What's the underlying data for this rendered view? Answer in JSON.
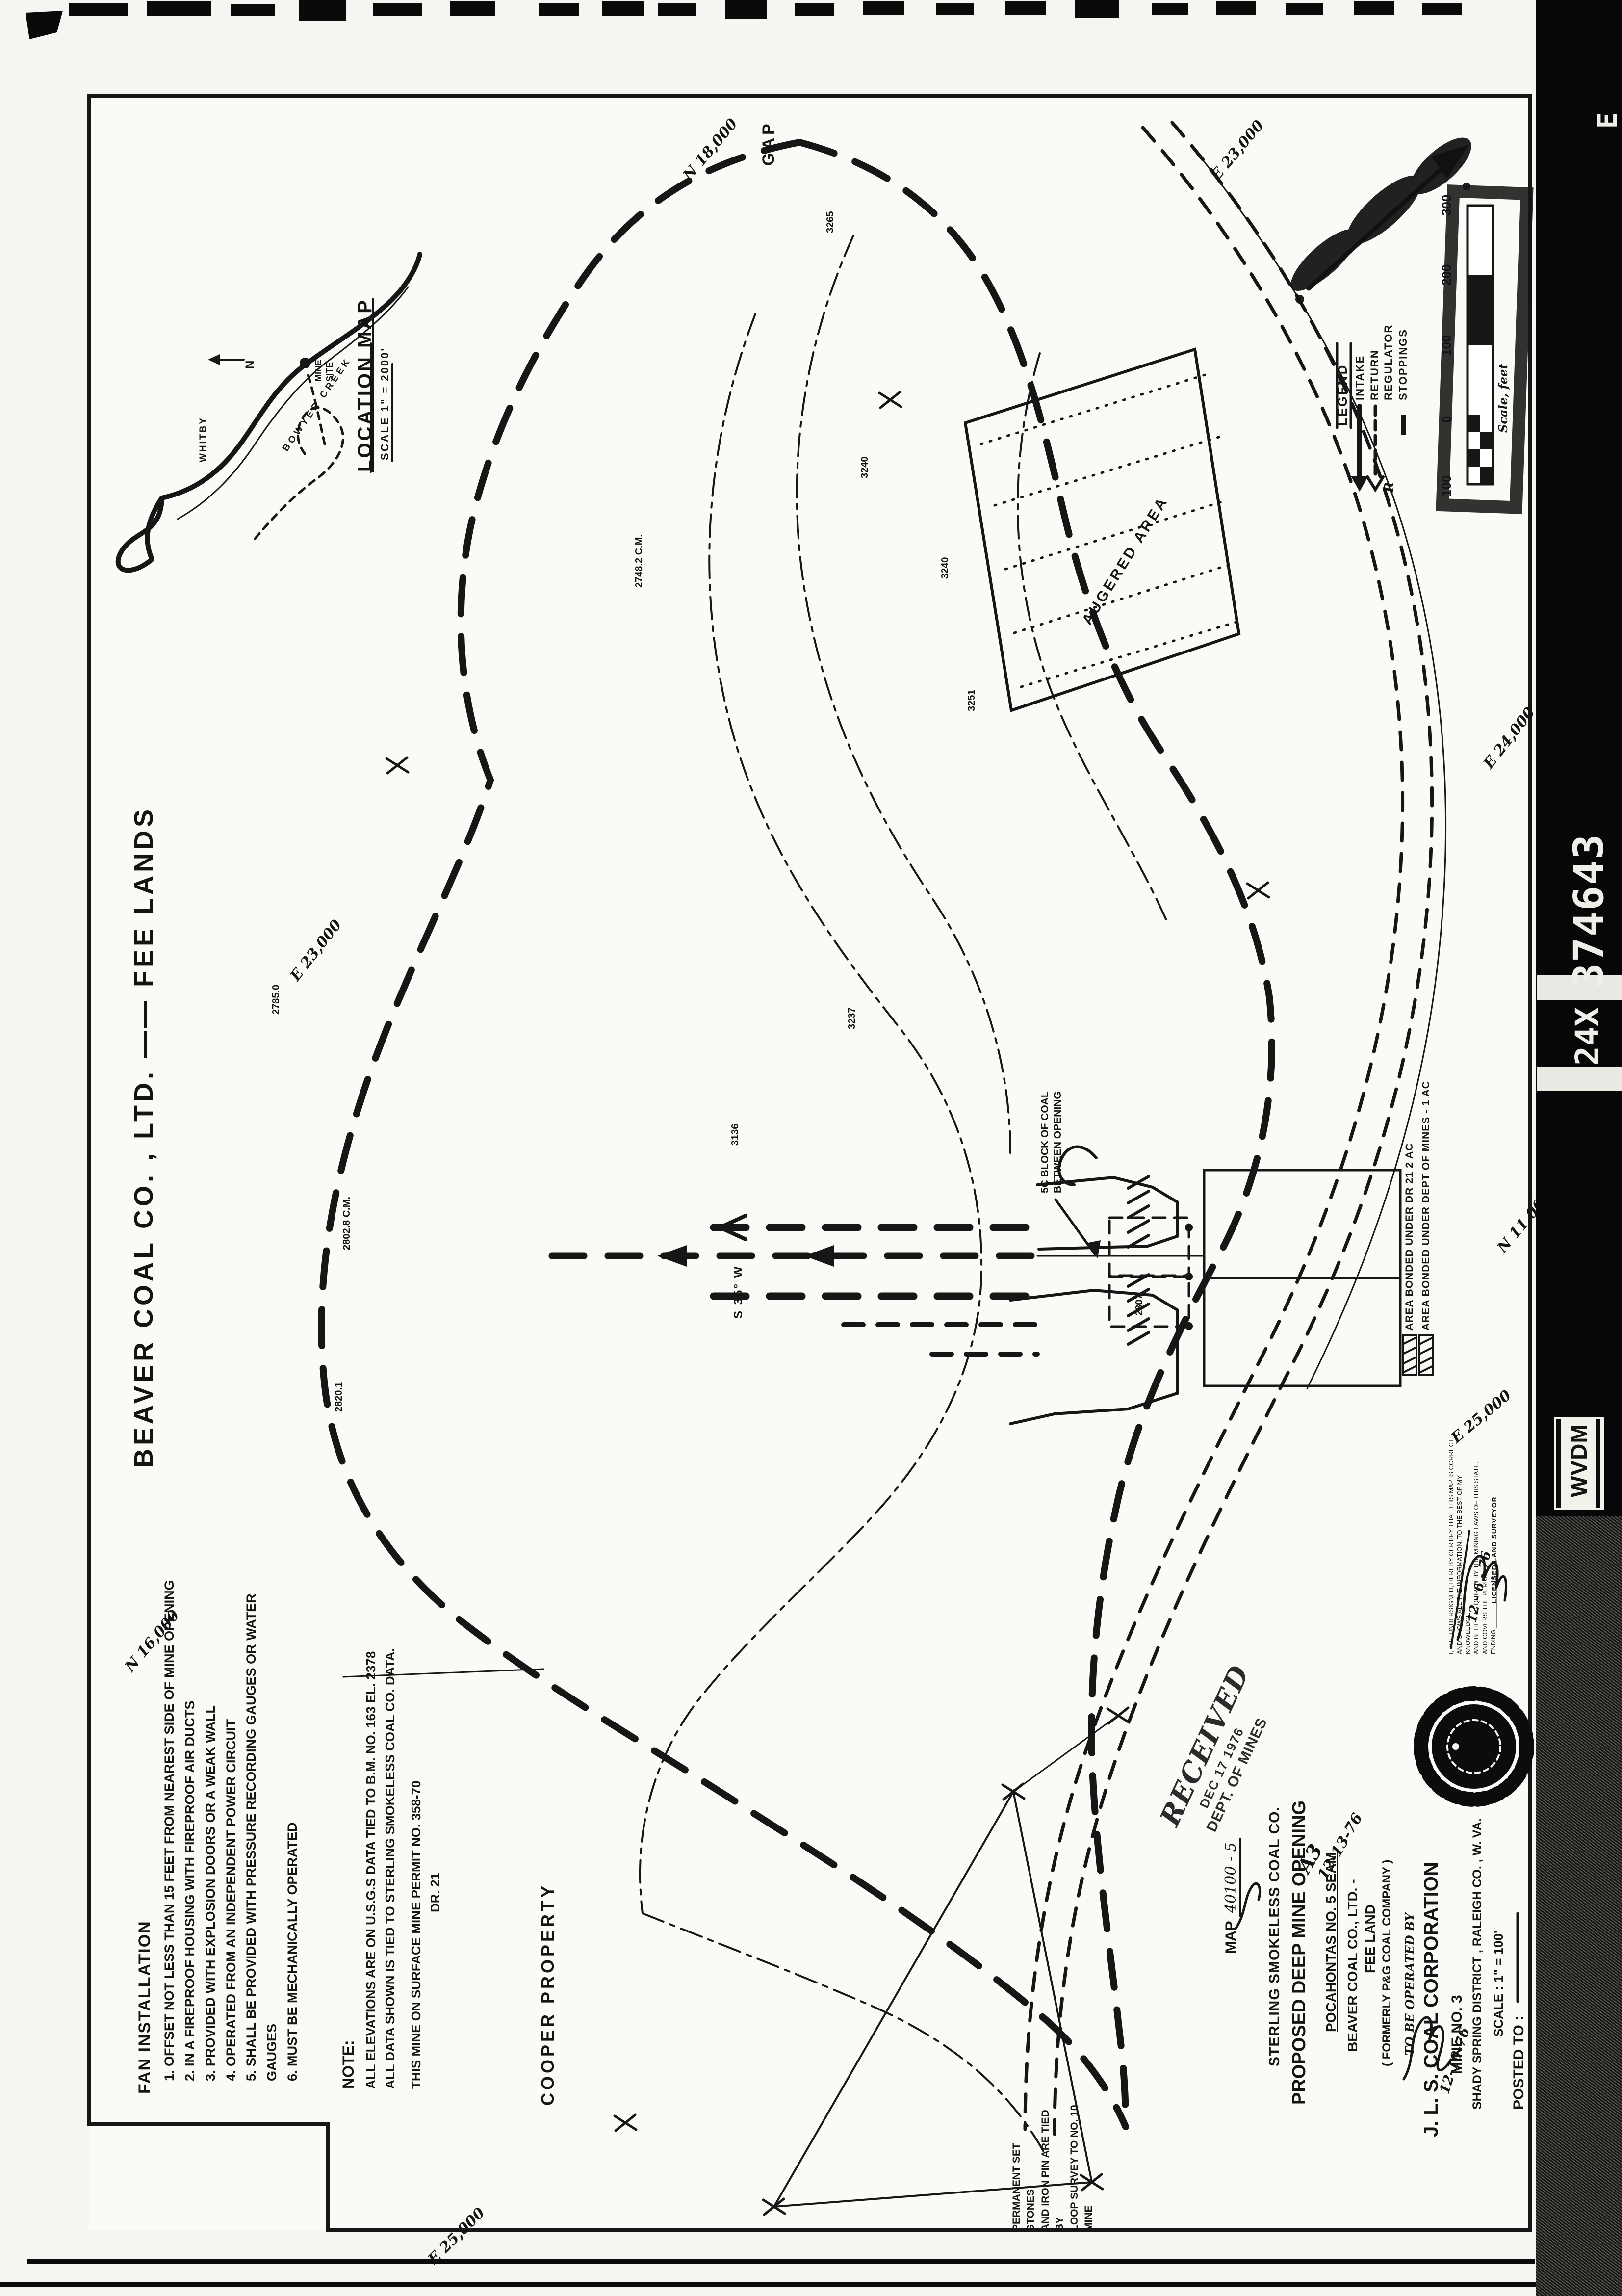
{
  "film_strip": {
    "frame_number": "374643",
    "reduction": "24X",
    "label": "WVDM",
    "frame_letter": "E"
  },
  "sheet": {
    "owner_title": "BEAVER  COAL  CO. , LTD.  ——  FEE  LANDS",
    "gap": "GAP",
    "cooper": "COOPER   PROPERTY",
    "augered": "AUGERED   AREA",
    "block_note_1": "5C BLOCK OF COAL",
    "block_note_2": "BETWEEN OPENING",
    "bearing": "S 35° W"
  },
  "location_map": {
    "title": "LOCATION  MAP",
    "scale": "SCALE  1\" = 2000'",
    "mine_site_1": "MINE",
    "mine_site_2": "SITE",
    "creek": "BOWYER  CREEK",
    "town": "WHITBY",
    "north": "N"
  },
  "fan": {
    "title": "FAN  INSTALLATION",
    "items": [
      "1. OFFSET NOT LESS THAN 15 FEET FROM NEAREST SIDE OF MINE OPENING",
      "2. IN A FIREPROOF HOUSING WITH FIREPROOF AIR DUCTS",
      "3. PROVIDED WITH EXPLOSION DOORS OR A WEAK WALL",
      "4. OPERATED FROM AN INDEPENDENT POWER CIRCUIT",
      "5. SHALL BE PROVIDED WITH PRESSURE RECORDING GAUGES OR WATER GAUGES",
      "6. MUST BE MECHANICALLY OPERATED"
    ]
  },
  "note": {
    "title": "NOTE:",
    "line1": "ALL ELEVATIONS ARE ON U.S.G.S DATA TIED TO B.M. NO. 163    EL. 2378",
    "line2": "ALL DATA SHOWN IS TIED TO STERLING SMOKELESS COAL CO.  DATA.",
    "line3": "THIS MINE ON SURFACE MINE PERMIT NO. 358-70",
    "line4": "DR. 21"
  },
  "legend": {
    "title": "LEGEND",
    "intake": "INTAKE",
    "return": "RETURN",
    "regulator": "REGULATOR",
    "stoppings": "STOPPINGS",
    "regulator_symbol": "R"
  },
  "scale_bar": {
    "labels": [
      "100",
      "0",
      "100",
      "200",
      "300"
    ],
    "caption": "Scale, feet"
  },
  "bonded": {
    "dr": "AREA BONDED UNDER DR 21   2 AC",
    "dom": "AREA BONDED UNDER DEPT OF MINES - 1 AC"
  },
  "stamp": {
    "received": "RECEIVED",
    "date": "DEC 17 1976",
    "dept": "DEPT. OF MINES"
  },
  "title_block": {
    "map_label": "MAP",
    "map_no": "40100 - 5",
    "company": "STERLING  SMOKELESS  COAL  CO.",
    "title": "PROPOSED  DEEP  MINE  OPENING",
    "seam": "POCAHONTAS  NO. 5  SEAM",
    "owner": "BEAVER  COAL  CO., LTD. -",
    "land": "FEE  LAND",
    "formerly": "( FORMERLY   P&G  COAL  COMPANY )",
    "annotation": "A3",
    "annotation_date": "12-13-76",
    "operated_by": "TO  BE  OPERATED  BY",
    "operator": "J. L. S.   COAL   CORPORATION",
    "mine_no": "MINE   NO.  3",
    "district": "SHADY  SPRING  DISTRICT ,  RALEIGH  CO. ,  W. VA.",
    "scale": "SCALE : 1\" =  100'",
    "posted": "POSTED  TO :",
    "posted_date": "12-10-76"
  },
  "certification": {
    "line1": "I, THE UNDERSIGNED, HEREBY CERTIFY THAT THIS MAP IS CORRECT,",
    "line2": "AND SHOWS ALL THE INFORMATION, TO THE BEST OF MY KNOWLEDGE",
    "line3": "AND BELIEF, REQUIRED BY THE MINING LAWS OF THIS STATE,",
    "line4": "AND COVERS THE PERIOD",
    "line5": "ENDING ____________  19 ____",
    "date": "12 - 6 - 76",
    "surveyor": "LICENSED LAND SURVEYOR"
  },
  "survey_note": {
    "line1": "PERMANENT  SET  STONES",
    "line2": "AND  IRON  PIN  ARE  TIED  BY",
    "line3": "LOOP  SURVEY  TO  NO. 10  MINE"
  },
  "grid_labels": [
    "N 18,000",
    "E 23,000",
    "E 23,000",
    "E 24,000",
    "E 25,000",
    "N 11,000",
    "E 25,000",
    "N 16,000"
  ],
  "elevations": [
    "3265",
    "3240",
    "3240",
    "3251",
    "3237",
    "3136",
    "2807",
    "2748.2 C.M.",
    "2802.8 C.M.",
    "2785.0",
    "2820.1"
  ]
}
